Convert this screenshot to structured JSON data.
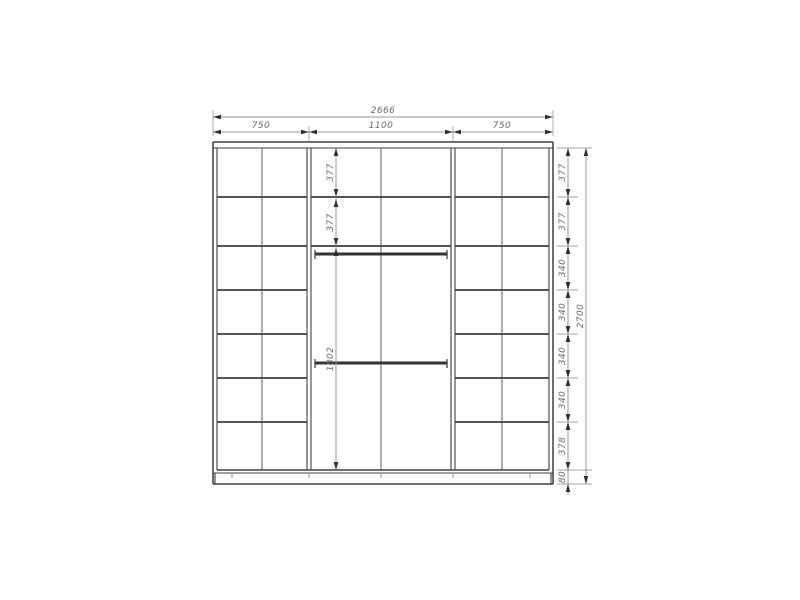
{
  "drawing": {
    "type": "wardrobe-front-elevation",
    "units": "mm",
    "colors": {
      "background": "#ffffff",
      "carcass_line": "#3f3f3f",
      "dimension_line": "#9a9a9a",
      "text": "#6a6a6a"
    },
    "top_dimensions": {
      "total_width": "2666",
      "section_widths": [
        "750",
        "1100",
        "750"
      ]
    },
    "right_dimensions": {
      "row_heights": [
        "377",
        "377",
        "340",
        "340",
        "340",
        "340",
        "378",
        "80"
      ],
      "total_height": "2700"
    },
    "interior_dimensions": {
      "shelf_heights": [
        "377",
        "377"
      ],
      "hanging_section_height": "1802"
    }
  }
}
